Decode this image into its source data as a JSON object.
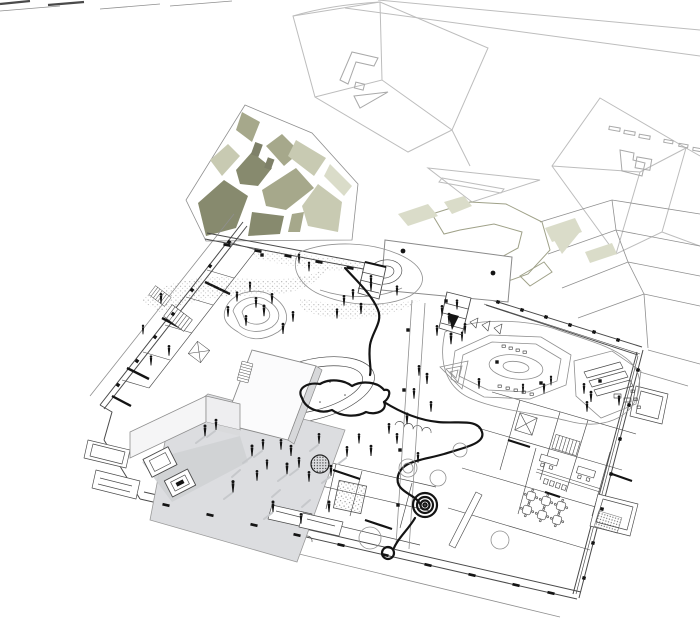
{
  "meta": {
    "description": "Axonometric black-and-white architectural site plan: tilted floor plan with landscaped playground, loop path, bold meandering wall, gray entry courtyard with L-shaped pavilion and sunken pit, olive-green fragmented garden plazas, scattered human figures, and light wireframe context buildings above",
    "canvas_width": 700,
    "canvas_height": 620,
    "background": "#ffffff"
  },
  "palette": {
    "paper": "#ffffff",
    "line-light": "#bdbdbd",
    "line-mid": "#8f8f8f",
    "line-dark": "#4a4a4a",
    "ink": "#141414",
    "olive-dark": "#878a6e",
    "olive-mid": "#a6a88b",
    "sage-light": "#c8cab2",
    "sage-pale": "#dadcc9",
    "courtyard-gray": "#dcdde0",
    "shadow-gray": "#c6c8cb",
    "face-gray": "#d7d8da",
    "pit-shadow": "#cfd1d4",
    "box-white": "#fbfbfc"
  },
  "scene": {
    "context_buildings": {
      "count": 3,
      "style": "light gray wireframe roofs"
    },
    "garden_plaza_upper_left": {
      "patch_tones": [
        "olive-dark",
        "olive-mid",
        "sage-light"
      ],
      "paths": "white gaps between patches"
    },
    "entry_plaza": {
      "shape": "white rotated rectangle",
      "black_dots": 2
    },
    "courtyard": {
      "fill_key": "courtyard-gray",
      "features": [
        "L-shaped white pavilion walls",
        "sunken stepped pit",
        "people with cast shadows"
      ]
    },
    "playground": {
      "features": [
        "contour hills",
        "stippled sand bands",
        "loop path",
        "ring donut",
        "bold meander wall",
        "spiral pad",
        "octagon terrace mound",
        "ramp mound",
        "flag triangles"
      ]
    },
    "building_interior": {
      "features": [
        "stairs",
        "elevator cores",
        "desks with chairs",
        "scalloped classroom tables",
        "sandbox",
        "benches",
        "column grid"
      ]
    },
    "figures": {
      "people_approx": 65,
      "courtyard_people_have_shadows": true
    }
  }
}
